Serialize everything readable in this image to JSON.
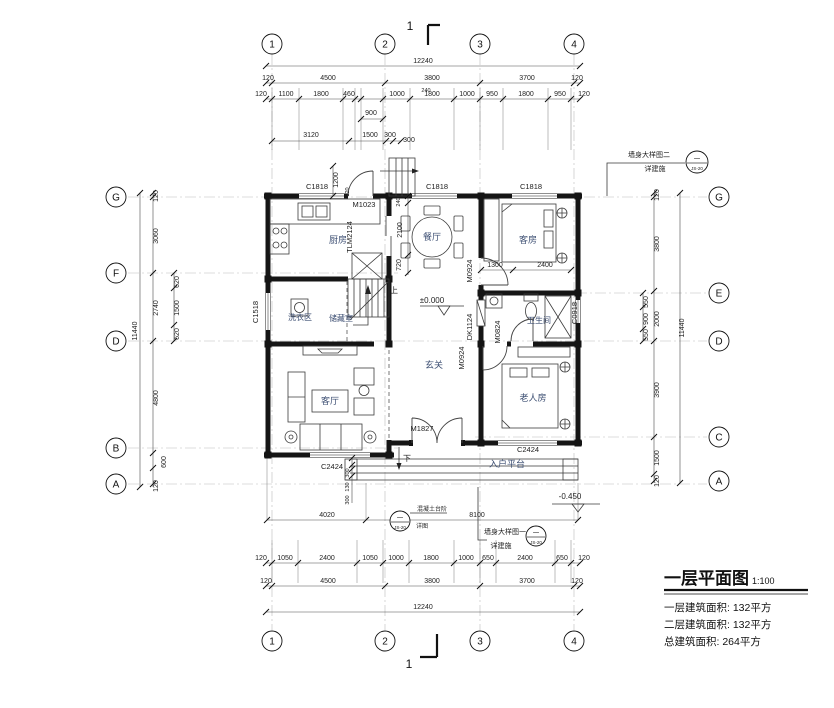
{
  "axes": {
    "cols": [
      "1",
      "2",
      "3",
      "4"
    ],
    "rows_left": [
      "G",
      "F",
      "D",
      "B",
      "A"
    ],
    "rows_right": [
      "G",
      "E",
      "D",
      "C",
      "A"
    ]
  },
  "dims": {
    "top_total": "12240",
    "top_major": [
      "120",
      "4500",
      "3800",
      "3700",
      "120"
    ],
    "top_minor": [
      "120",
      "1100",
      "1800",
      "460",
      "1000",
      "1800",
      "1000",
      "950",
      "1800",
      "950",
      "120"
    ],
    "top_extra": {
      "d240": "240",
      "d900": "900",
      "d3120": "3120",
      "d1500": "1500",
      "d300a": "300",
      "d300b": "300",
      "d1200": "1200",
      "d120": "120"
    },
    "bottom_total": "12240",
    "bottom_major": [
      "120",
      "4500",
      "3800",
      "3700",
      "120"
    ],
    "bottom_minor": [
      "120",
      "1050",
      "2400",
      "1050",
      "1000",
      "1800",
      "1000",
      "650",
      "2400",
      "650",
      "120"
    ],
    "bottom_extra": {
      "d4020": "4020",
      "d8100": "8100",
      "d300a": "300",
      "d130": "130",
      "d300b": "300"
    },
    "left": {
      "total": "11440",
      "major": [
        "120",
        "3060",
        "2740",
        "4800",
        "600",
        "120"
      ],
      "sub": [
        "620",
        "1500",
        "620"
      ]
    },
    "right": {
      "total": "11440",
      "major": [
        "120",
        "3800",
        "2000",
        "3900",
        "1500",
        "120"
      ],
      "sub": [
        "550",
        "900",
        "550"
      ]
    },
    "interior": {
      "d240": "240",
      "d2100": "2100",
      "d720": "720",
      "d1300": "1300",
      "d2400": "2400"
    }
  },
  "openings": {
    "c1818": "C1818",
    "m1023": "M1023",
    "tlm2124": "TLM2124",
    "c1518": "C1518",
    "m0924": "M0924",
    "dk1124": "DK1124",
    "m0824": "M0824",
    "c0918": "C0918",
    "m1827": "M1827",
    "c2424": "C2424"
  },
  "rooms": {
    "kitchen": "厨房",
    "dining": "餐厅",
    "guest": "客房",
    "laundry": "洗衣区",
    "storage": "储藏室",
    "bath": "卫生间",
    "foyer": "玄关",
    "living": "客厅",
    "elder": "老人房",
    "platform": "入户平台"
  },
  "levels": {
    "zero": "±0.000",
    "minus": "-0.450"
  },
  "stairs": {
    "up": "上",
    "down": "下"
  },
  "notes": {
    "section": "1",
    "wall_detail_2": {
      "line1": "墙身大样图二",
      "line2": "详建施",
      "tag_top": "一",
      "tag_bottom": "JS-20"
    },
    "wall_detail_1": {
      "line1": "墙身大样图一",
      "line2": "详建施",
      "tag_top": "一",
      "tag_bottom": "JS-20"
    },
    "steps": {
      "line1": "混凝土台阶",
      "line2": "详图",
      "tag_top": "一",
      "tag_bottom": "JS-20"
    }
  },
  "title_block": {
    "title": "一层平面图",
    "scale": "1:100",
    "line1": "一层建筑面积: 132平方",
    "line2": "二层建筑面积: 132平方",
    "line3": "总建筑面积: 264平方"
  }
}
